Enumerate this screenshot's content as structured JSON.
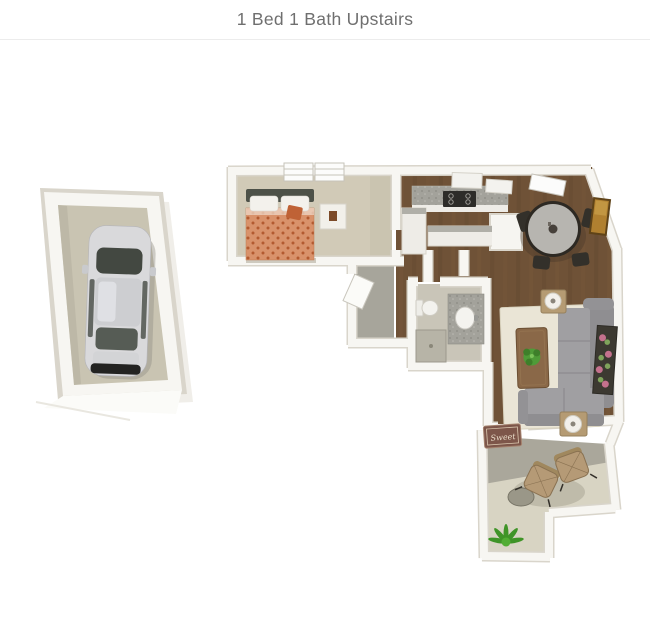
{
  "header": {
    "title": "1 Bed 1 Bath Upstairs"
  },
  "floorplan": {
    "mat_text": "Sweet"
  },
  "colors": {
    "title": "#6f6f6f",
    "divider": "#ececec",
    "wallFace": "#f7f6f2",
    "wallEdge": "#d9d5cb",
    "carpet": "#d1cab7",
    "wood": "#6f5237",
    "landing": "#a7a59b",
    "garageFloor": "#c9c4b2",
    "rug": "#eae5d6",
    "sofa": "#a09fa2",
    "mat": "#7d564a",
    "matText": "#e9dcc9",
    "patioDark": "#aaa79b",
    "patioLight": "#d8d4c3"
  }
}
